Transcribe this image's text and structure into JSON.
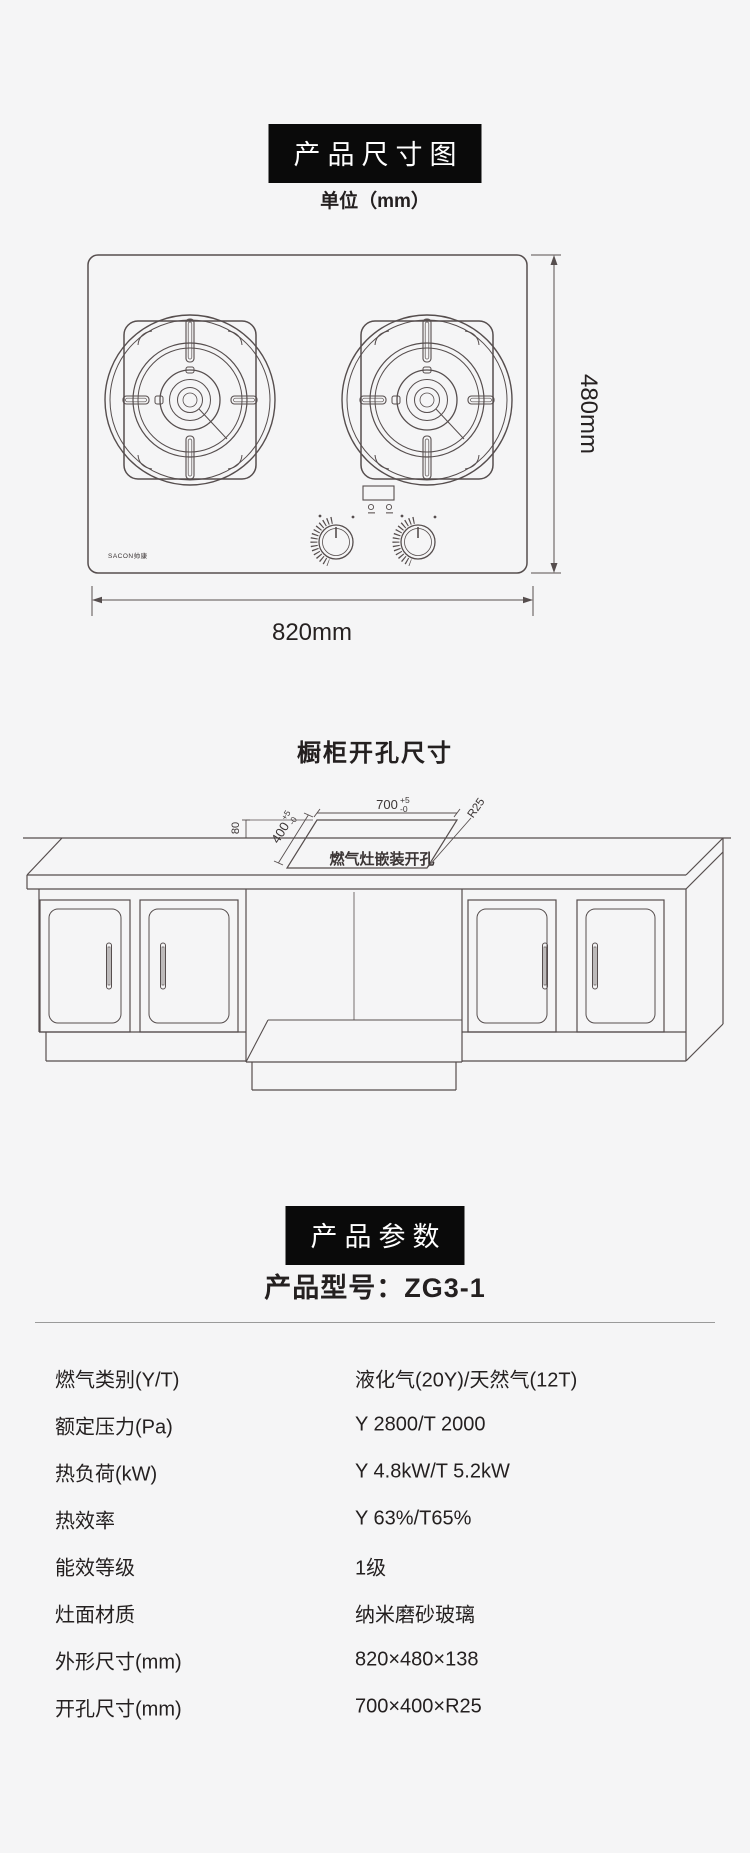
{
  "dimension_section": {
    "badge": "产品尺寸图",
    "unit": "单位（mm）",
    "width_label": "820mm",
    "height_label": "480mm",
    "brand_logo": "SACON帅康"
  },
  "cutout_section": {
    "title": "橱柜开孔尺寸",
    "depth_dim": {
      "main": "400",
      "sup": "+5",
      "sub": "-0"
    },
    "width_dim": {
      "main": "700",
      "sup": "+5",
      "sub": "-0"
    },
    "corner_radius": "R25",
    "back_offset": "80",
    "cutout_label": "燃气灶嵌装开孔"
  },
  "params_section": {
    "badge": "产品参数",
    "model": "产品型号：ZG3-1",
    "rows": [
      {
        "label": "燃气类别(Y/T)",
        "value": "液化气(20Y)/天然气(12T)"
      },
      {
        "label": "额定压力(Pa)",
        "value": "Y 2800/T 2000"
      },
      {
        "label": "热负荷(kW)",
        "value": "Y 4.8kW/T 5.2kW"
      },
      {
        "label": "热效率",
        "value": "Y 63%/T65%"
      },
      {
        "label": "能效等级",
        "value": "1级"
      },
      {
        "label": "灶面材质",
        "value": "纳米磨砂玻璃"
      },
      {
        "label": "外形尺寸(mm)",
        "value": "820×480×138"
      },
      {
        "label": "开孔尺寸(mm)",
        "value": "700×400×R25"
      }
    ]
  }
}
